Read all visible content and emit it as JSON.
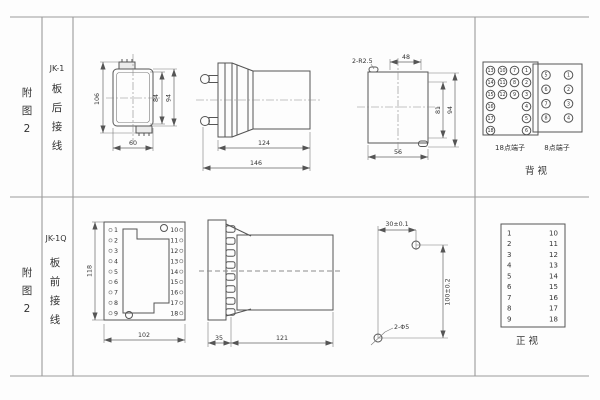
{
  "rows": [
    {
      "fig": [
        "附",
        "图",
        "2"
      ],
      "model": "JK-1",
      "wiring": [
        "板",
        "后",
        "接",
        "线"
      ],
      "rear": {
        "h_total": "106",
        "h_inner": "84",
        "h_outer": "94",
        "w": "60"
      },
      "side": {
        "body": "124",
        "total": "146"
      },
      "cutout": {
        "slots": "2-R2.5",
        "top": "48",
        "h_inner": "81",
        "h_outer": "94",
        "bottom": "56"
      },
      "term18": {
        "label": "18点端子",
        "rows": [
          [
            "13",
            "10",
            "7",
            "1"
          ],
          [
            "14",
            "11",
            "8",
            "2"
          ],
          [
            "15",
            "12",
            "9",
            "3"
          ],
          [
            "16",
            "",
            "",
            "4"
          ],
          [
            "17",
            "",
            "",
            "5"
          ],
          [
            "18",
            "",
            "",
            "6"
          ]
        ]
      },
      "term8": {
        "label": "8点端子",
        "rows": [
          [
            "5",
            "1"
          ],
          [
            "6",
            "2"
          ],
          [
            "7",
            "3"
          ],
          [
            "8",
            "4"
          ]
        ]
      },
      "view_label": "背 视"
    },
    {
      "fig": [
        "附",
        "图",
        "2"
      ],
      "model": "JK-1Q",
      "wiring": [
        "板",
        "前",
        "接",
        "线"
      ],
      "front": {
        "h": "118",
        "w": "102",
        "left": [
          "1",
          "2",
          "3",
          "4",
          "5",
          "6",
          "7",
          "8",
          "9"
        ],
        "right": [
          "10",
          "11",
          "12",
          "13",
          "14",
          "15",
          "16",
          "17",
          "18"
        ]
      },
      "side": {
        "panel": "35",
        "body": "121"
      },
      "drill": {
        "dx": "30±0.1",
        "dy": "100±0.2",
        "holes": "2-Φ5"
      },
      "map": {
        "left": [
          "1",
          "2",
          "3",
          "4",
          "5",
          "6",
          "7",
          "8",
          "9"
        ],
        "right": [
          "10",
          "11",
          "12",
          "13",
          "14",
          "15",
          "16",
          "17",
          "18"
        ],
        "view_label": "正 视"
      }
    }
  ],
  "colors": {
    "line": "#555",
    "grid": "#9b9b9b",
    "text": "#333"
  }
}
